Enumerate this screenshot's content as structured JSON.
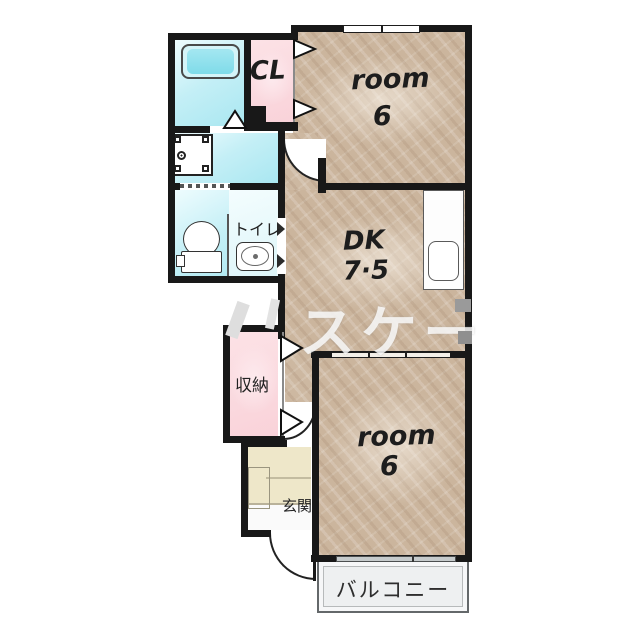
{
  "floorplan": {
    "rooms": {
      "room_top": {
        "name": "room",
        "size": "6"
      },
      "dk": {
        "name": "DK",
        "size": "7·5"
      },
      "room_bottom": {
        "name": "room",
        "size": "6"
      },
      "closet": {
        "label": "CL"
      },
      "storage": {
        "label": "収納"
      },
      "toilet": {
        "label": "トイレ"
      },
      "entrance": {
        "label": "玄関"
      },
      "balcony": {
        "label": "バルコニー"
      }
    },
    "watermark": {
      "text": "スケー"
    },
    "colors": {
      "wall": "#181818",
      "wet_floor": "#bfeef5",
      "closet_pink": "#fbd9de",
      "room_floor": "#cbb59d",
      "entrance_floor": "#eee7c9",
      "balcony_floor": "#eef0f1"
    }
  }
}
